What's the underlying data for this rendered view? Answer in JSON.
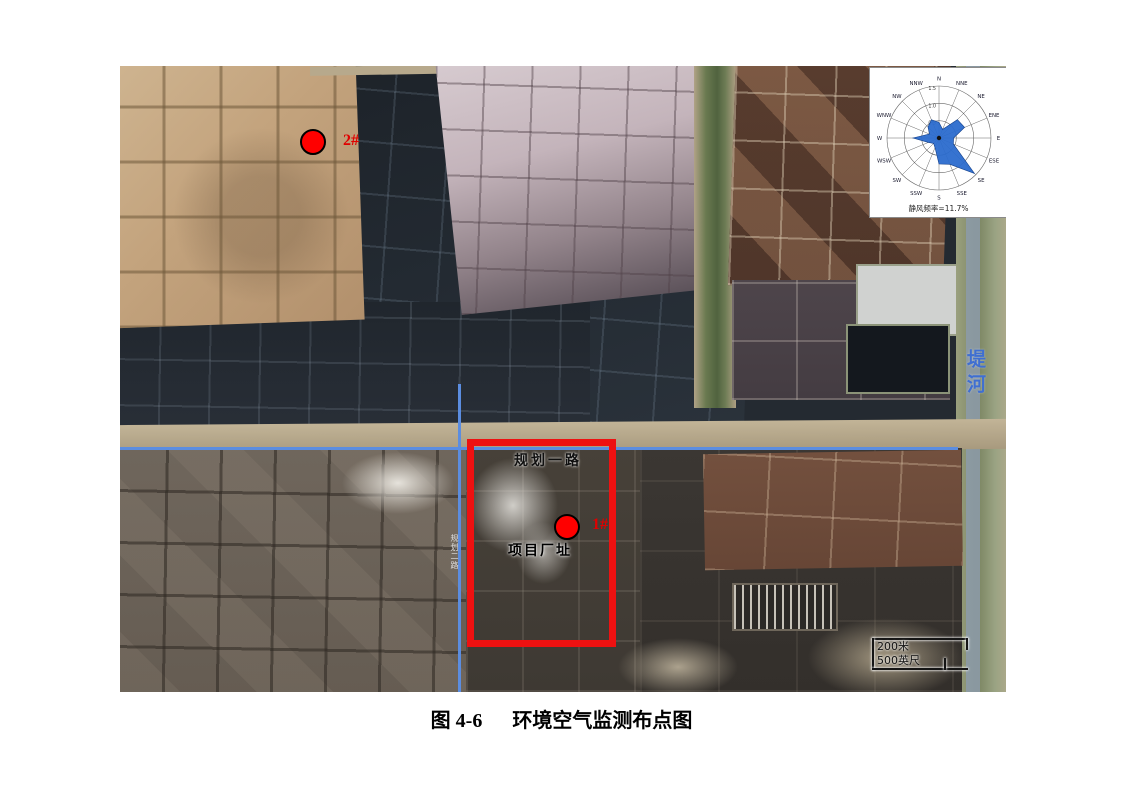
{
  "figure": {
    "caption_label": "图 4-6",
    "caption_title": "环境空气监测布点图"
  },
  "map": {
    "labels": {
      "planned_road": "规划一路",
      "project_site": "项目厂址",
      "vertical_road": "规划二路",
      "river": "堤河"
    },
    "markers": [
      {
        "label": "2#"
      },
      {
        "label": "1#"
      }
    ],
    "scale_bar": {
      "metric": "200米",
      "imperial": "500英尺"
    }
  },
  "chart_data": {
    "type": "windrose",
    "directions": [
      "N",
      "NNE",
      "NE",
      "ENE",
      "E",
      "ESE",
      "SE",
      "SSE",
      "S",
      "SSW",
      "SW",
      "WSW",
      "W",
      "WNW",
      "NW",
      "NNW"
    ],
    "frequencies": [
      0.45,
      0.27,
      0.75,
      0.8,
      0.42,
      0.45,
      1.45,
      0.82,
      0.75,
      0.3,
      0.22,
      0.33,
      0.75,
      0.3,
      0.45,
      0.57
    ],
    "radial_ticks": [
      0.5,
      1.0,
      1.5
    ],
    "rmax": 1.5,
    "calm_label": "静风频率=11.7%",
    "fill_color": "#2b6bcd",
    "legend_position": "none",
    "grid": true
  },
  "colors": {
    "marker_red": "#ff0000",
    "boundary_red": "#ee1111",
    "crosshair_blue": "#5b8de0",
    "river_label_blue": "#3f6fd1"
  }
}
